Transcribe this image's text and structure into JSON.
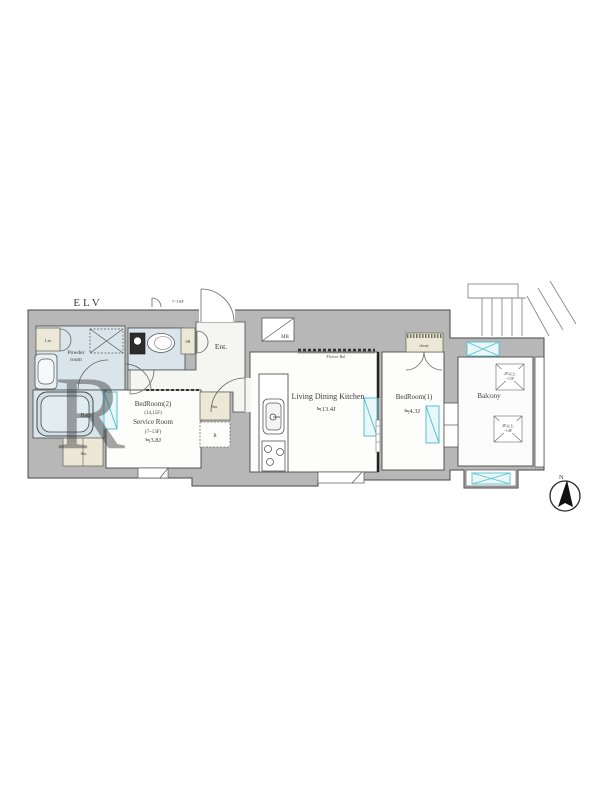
{
  "page": {
    "width": 600,
    "height": 800,
    "background": "#ffffff"
  },
  "colors": {
    "wall_fill": "#b7b7b7",
    "wall_stroke": "#474747",
    "wet_room_fill": "#d9e5eb",
    "room_fill": "#fdfdfc",
    "storage_fill": "#ebe8d8",
    "window_stroke": "#56c1d0",
    "window_fill": "#e9f7f9",
    "label_color": "#3a3a3a",
    "watermark_color": "#c3d2dd"
  },
  "labels": {
    "elevator": "ELV",
    "entrance": "Ent.",
    "meter_box": "MB",
    "shoe_box": "SB",
    "linen": "Lin",
    "powder_room": [
      "Powder",
      "room"
    ],
    "bath": "Bath",
    "storage_bath": "Sto.",
    "storage_hall": "Sto.",
    "refrigerator": "R",
    "door_floors_note": "7~10F",
    "closet": "closet",
    "flower_balcony": "Flower Bal",
    "bedroom2": {
      "line1": "BedRoom(2)",
      "line2": "(14,15F)",
      "line3": "Service Room",
      "line4": "(7~13F)",
      "line5": "≒3.8J"
    },
    "living_dining_kitchen": {
      "line1": "Living Dining Kitchen",
      "line2": "≒13.4J"
    },
    "bedroom1": {
      "line1": "BedRoom(1)",
      "line2": "≒4.3J"
    },
    "balcony": "Balcony",
    "hatch_upper": {
      "line1": "2F以上",
      "line2": "~15F"
    },
    "hatch_lower": {
      "line1": "4F以上",
      "line2": "~14F"
    },
    "compass_north": "N",
    "watermark": "R"
  }
}
